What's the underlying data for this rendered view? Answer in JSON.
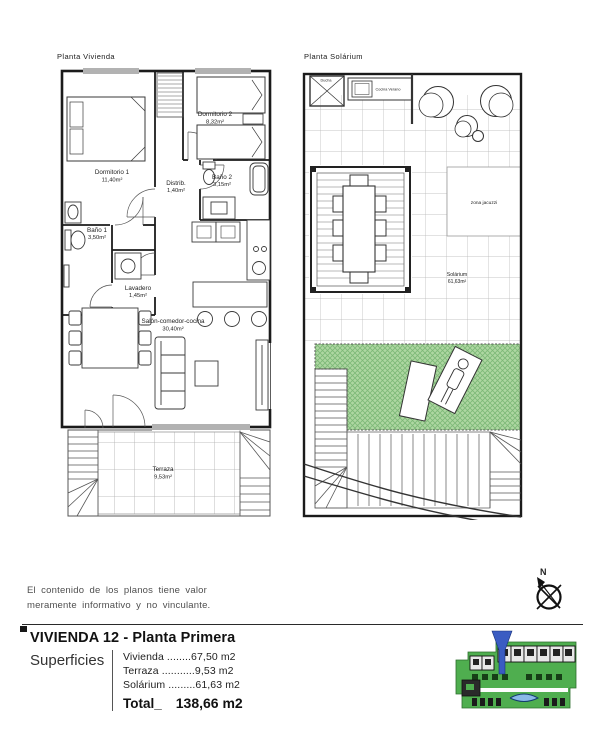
{
  "plans": {
    "vivienda": {
      "label": "Planta Vivienda",
      "rooms": [
        {
          "name": "Dormitorio 1",
          "area": "11,40m²"
        },
        {
          "name": "Dormitorio 2",
          "area": "8,32m²"
        },
        {
          "name": "Distrib.",
          "area": "1,40m²"
        },
        {
          "name": "Baño 2",
          "area": "3,15m²"
        },
        {
          "name": "Baño 1",
          "area": "3,50m²"
        },
        {
          "name": "Lavadero",
          "area": "1,45m²"
        },
        {
          "name": "Salón-comedor-cocina",
          "area": "30,40m²"
        },
        {
          "name": "Terraza",
          "area": "9,53m²"
        }
      ]
    },
    "solarium": {
      "label": "Planta Solárium",
      "labels": {
        "ducha": "Ducha",
        "cocina_verano": "Cocina Verano",
        "zona_jacuzzi": "zona jacuzzi",
        "solarium_name": "Solárium",
        "solarium_area": "61,63m²"
      }
    }
  },
  "disclaimer": {
    "line1": "El contenido de los planos tiene valor",
    "line2": "meramente informativo y no vinculante."
  },
  "compass": {
    "north": "N"
  },
  "title_block": {
    "title": "VIVIENDA 12 - Planta Primera",
    "superficies": "Superficies",
    "rows": [
      {
        "text": "Vivienda ........67,50 m2"
      },
      {
        "text": "Terraza ...........9,53 m2"
      },
      {
        "text": "Solárium .........61,63 m2"
      }
    ],
    "total_label": "Total_",
    "total_value": "138,66 m2"
  },
  "colors": {
    "wall": "#1b1b1b",
    "grass_green": "#aed7a2",
    "marker_blue": "#3a5cc2",
    "pool_blue": "#8ab9e8",
    "site_green": "#4fae4f"
  }
}
